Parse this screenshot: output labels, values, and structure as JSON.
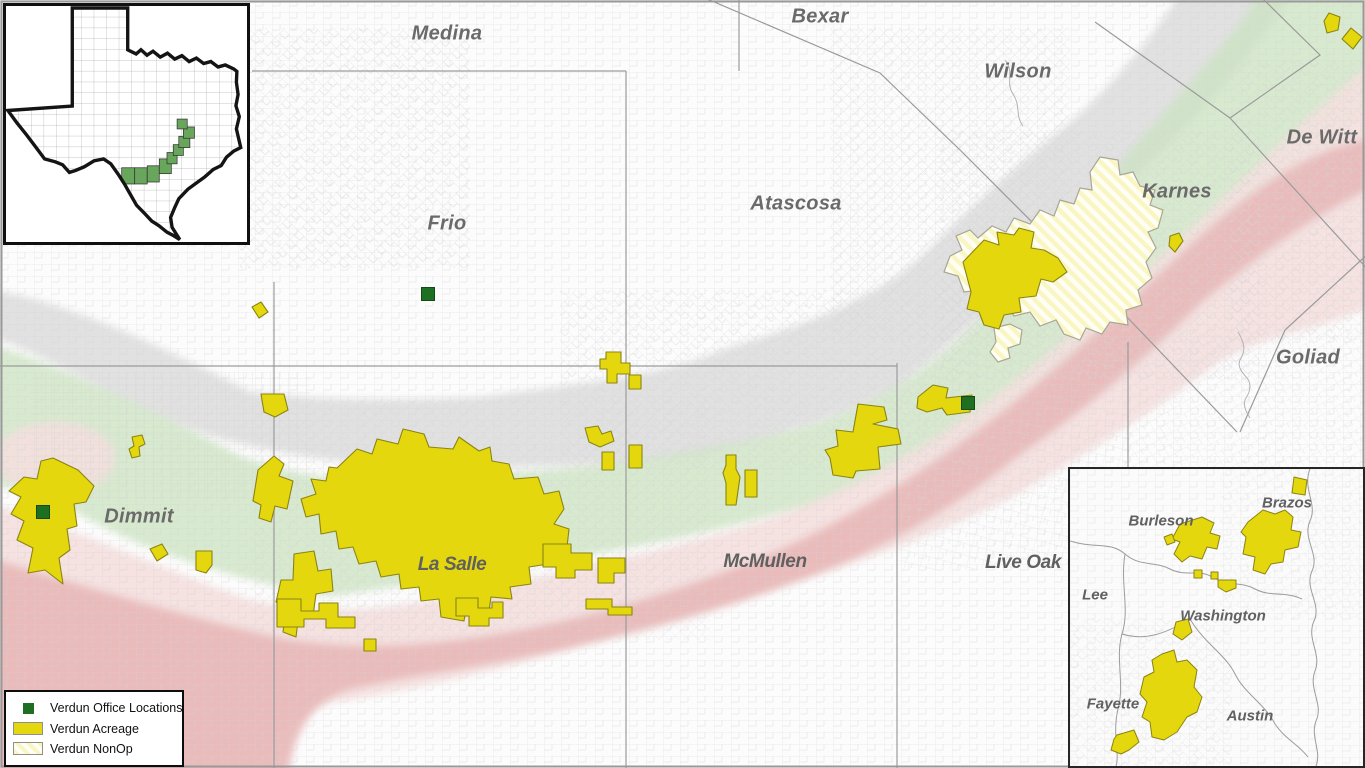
{
  "colors": {
    "office": "#1e6f22",
    "acreage": "#e4d70d",
    "acreage_outline": "#8a8414",
    "nonop_base": "#faf6c4",
    "band_gray": "#dcdcdc",
    "band_green": "#cde5c3",
    "band_pink_light": "#f4dfde",
    "band_pink_dark": "#e9b9b8",
    "tx_highlight": "#68a65c"
  },
  "map": {
    "county_labels": [
      {
        "name": "Medina",
        "x": 447,
        "y": 34
      },
      {
        "name": "Bexar",
        "x": 820,
        "y": 17
      },
      {
        "name": "Wilson",
        "x": 1018,
        "y": 72
      },
      {
        "name": "De Witt",
        "x": 1322,
        "y": 138
      },
      {
        "name": "Frio",
        "x": 447,
        "y": 224
      },
      {
        "name": "Atascosa",
        "x": 796,
        "y": 204
      },
      {
        "name": "Karnes",
        "x": 1177,
        "y": 192
      },
      {
        "name": "Goliad",
        "x": 1308,
        "y": 358
      },
      {
        "name": "Dimmit",
        "x": 139,
        "y": 517
      },
      {
        "name": "La Salle",
        "x": 452,
        "y": 565,
        "cls": "condensed"
      },
      {
        "name": "McMullen",
        "x": 765,
        "y": 562,
        "cls": "condensed"
      },
      {
        "name": "Live Oak",
        "x": 1023,
        "y": 563,
        "cls": "condensed"
      }
    ],
    "office_locations": [
      {
        "x": 428,
        "y": 294
      },
      {
        "x": 43,
        "y": 512
      },
      {
        "x": 968,
        "y": 403
      }
    ]
  },
  "east_inset": {
    "county_labels": [
      {
        "name": "Burleson",
        "x": 1161,
        "y": 521
      },
      {
        "name": "Brazos",
        "x": 1287,
        "y": 503
      },
      {
        "name": "Lee",
        "x": 1095,
        "y": 595
      },
      {
        "name": "Washington",
        "x": 1223,
        "y": 616
      },
      {
        "name": "Fayette",
        "x": 1113,
        "y": 704
      },
      {
        "name": "Austin",
        "x": 1250,
        "y": 716
      }
    ]
  },
  "legend": {
    "items": [
      {
        "key": "office",
        "label": "Verdun Office Locations"
      },
      {
        "key": "acreage",
        "label": "Verdun Acreage"
      },
      {
        "key": "nonop",
        "label": "Verdun NonOp"
      }
    ]
  }
}
